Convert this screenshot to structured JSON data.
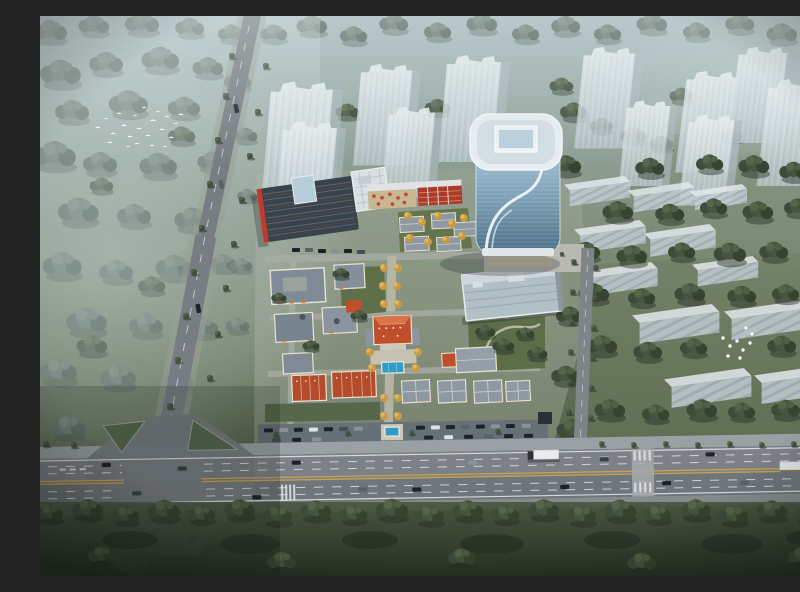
{
  "meta": {
    "title": "Aerial rendering of a mixed-use residential development",
    "description": "Hazy aerial architectural rendering: a low-rise European-style village with orange and grey roofs, a curved blue glass office tower, a sawtooth-roof commercial block and an exhibition hall, surrounded by ghosted white massing towers and slabs, misty woodland with a bird flock, a diagonal secondary road and a tree-lined arterial road with a channelized intersection."
  },
  "colors": {
    "fog": "#c7d4d6",
    "haze_top": "#a4b6b9",
    "ground_dark": "#37422f",
    "lawn": "#77866b",
    "forest_dark": "#36432f",
    "forest_fog": "#57665c",
    "ghost_face": "#dde6ea",
    "ghost_side": "#aab7bf",
    "glass_light": "#a9c6d8",
    "glass_dark": "#4c6e86",
    "tower_roof": "#e7edf1",
    "road_asphalt": "#7b8187",
    "sidewalk": "#9aa0a3",
    "lane_yellow": "#c8a14e",
    "lane_white": "#dfe3e3",
    "roof_orange": "#bf4f2c",
    "roof_red": "#ab3a2b",
    "roof_gray": "#8d98a3",
    "wall_cream": "#e9e2d2",
    "pool_blue": "#2f9dc4",
    "accent_red": "#c23a2e",
    "autumn_tree": "#cfa04a",
    "plaza": "#c2bcae",
    "car_dark": "#1d2226",
    "truck_white": "#e8ecee",
    "bird_white": "#f4f7f7"
  },
  "scene": {
    "landmarks": {
      "glass_tower": "Curved glass office tower with white crown",
      "commercial_center": "Commercial block with sawtooth skylight roof and red trim",
      "retail_strip": "Red-roof retail arcade with terrace umbrellas",
      "podium_hall": "Flat-roof exhibition hall",
      "chateau": "Central chateau with forecourt swimming pool",
      "townhouses": "Orange-roof townhouse rows",
      "villas": "Grey-roof villa row",
      "main_road": "Tree-lined arterial road with yellow centre lines",
      "diagonal_road": "Secondary road crossing at channelized intersection",
      "intersection": "Intersection with four grass islands",
      "forest": "Misty woodland with flock of white birds",
      "ghost_blocks": "Translucent massing volumes of surrounding districts"
    },
    "counts": {
      "ghost_highrise_towers": 11,
      "ghost_row_buildings": 12,
      "vehicles_on_arterial": 16,
      "vehicles_on_diagonal_road": 4,
      "parked_cars": 24,
      "birds_in_flock": 22,
      "egrets_on_lawn": 11,
      "swimming_pools": 2,
      "grass_islands_at_intersection": 4
    },
    "environment": {
      "weather": "morning haze with fog over the woodland",
      "vegetation": "dark green tree clusters with scattered golden autumn trees"
    }
  }
}
